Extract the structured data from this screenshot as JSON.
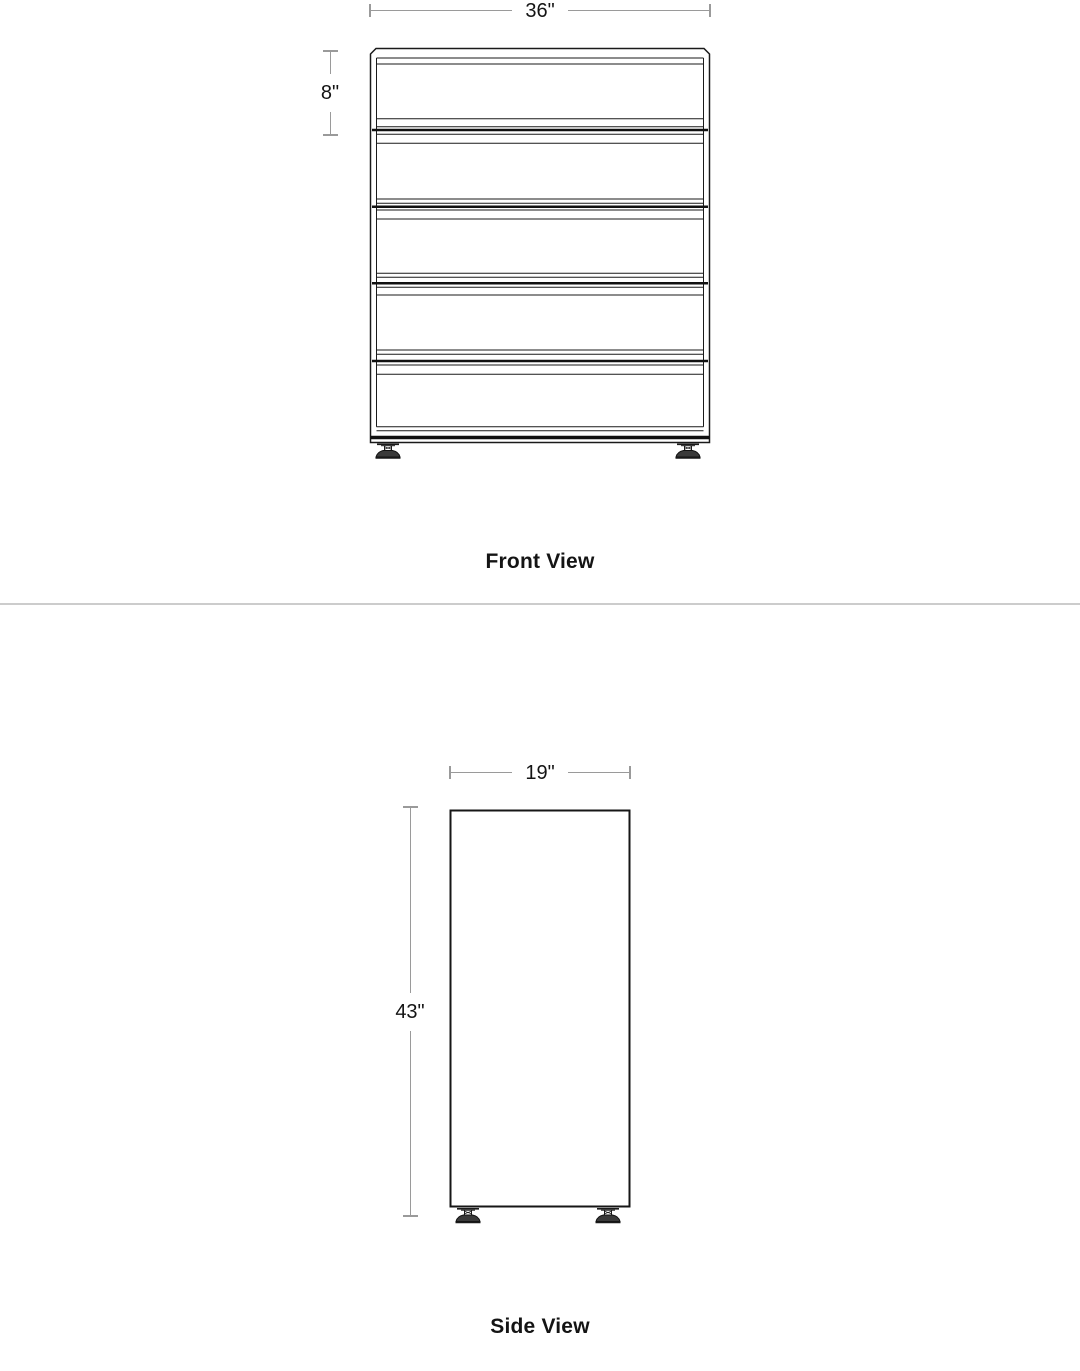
{
  "page": {
    "background": "#ffffff"
  },
  "front_view": {
    "label": "Front View",
    "width_dimension": "36\"",
    "top_drawer_height_dimension": "8\"",
    "drawer_count": 5,
    "feet_count": 2
  },
  "side_view": {
    "label": "Side View",
    "depth_dimension": "19\"",
    "height_dimension": "43\"",
    "feet_count": 2
  },
  "colors": {
    "drawing_line": "#1a1a1a",
    "dimension_line": "#9a9a9a",
    "label_text": "#141414",
    "divider": "#cccccc"
  }
}
